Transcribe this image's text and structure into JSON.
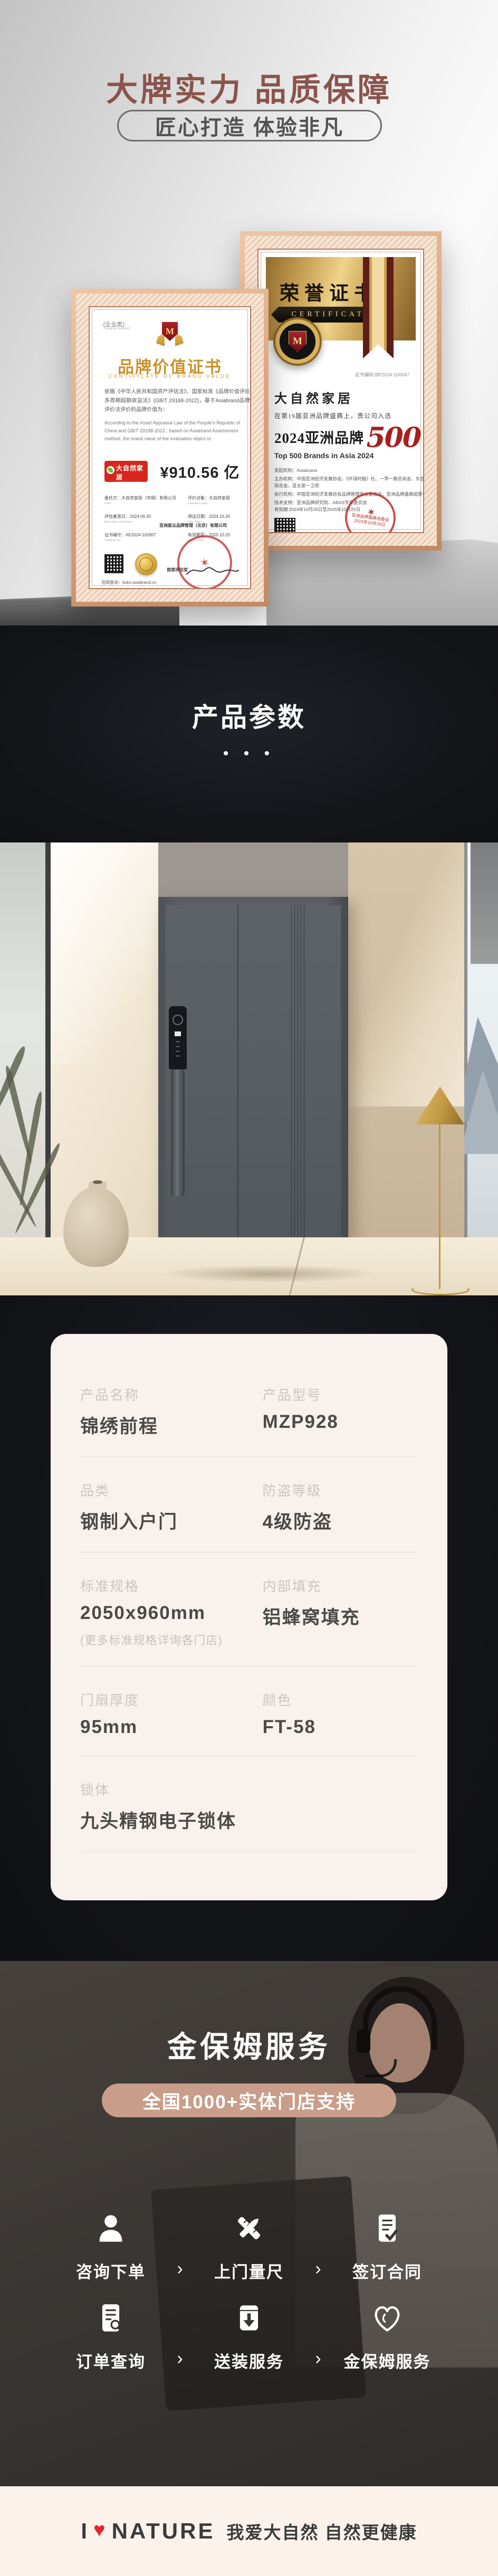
{
  "colors": {
    "hero_title": "#8a544c",
    "pill_tan": "#c89e8a",
    "heart_red": "#e2262c",
    "brand_logo_red": "#d6271f",
    "cert_gold": "#c8922d",
    "dark_section_bg": "#141519",
    "card_bg": "#f9f1ee"
  },
  "hero": {
    "title": "大牌实力 品质保障",
    "subtitle": "匠心打造 体验非凡"
  },
  "cert_left": {
    "category": "·(企业类)·",
    "category_en": "Category Selected",
    "emblem_letter": "M",
    "title": "品牌价值证书",
    "subtitle": "CERTIFICATE OF BRAND VALUE",
    "body_cn": "依据《中华人民共和国资产评估法》、国家标准《品牌价值评价多周期超额收益法》(GB/T 29188-2022)，基于Asiabrand品牌评价法评价的品牌价值为：",
    "body_en": "According to the Asset Appraisal Law of the People's Republic of China and GB/T 29188-2022 , based on Asiabrand Assessment method, the brand value of the evaluation object is:",
    "brand_cn": "大自然家居",
    "brand_en": "NATURE HOME",
    "value": "¥910.56 亿",
    "fields": [
      {
        "label": "委托方：大自然家居（中国）有限公司",
        "sub": "Client"
      },
      {
        "label": "评价对象：大自然家居",
        "sub": "Evaluation target"
      },
      {
        "label": "评估基准日：2024.09.30",
        "sub": "Base Date of Evaluation"
      },
      {
        "label": "颁证日期：2024.10.26",
        "sub": "Issue Date"
      },
      {
        "label": "证书编号：AE2024-102657",
        "sub": "Certificate No."
      },
      {
        "label": "有效期至：2025.10.25",
        "sub": "Effective Date"
      }
    ],
    "stamp_company": "亚洲星云品牌管理（北京）有限公司",
    "stamp_role": "首席评估官",
    "stamp_star": "✶",
    "website": "官网查询：bsks.asiabrand.cn"
  },
  "cert_right": {
    "title": "荣誉证书",
    "ribbon": "CERTIFICATE",
    "medal_letter": "M",
    "code": "证书编码:BP2024-100047",
    "brand": "大自然家居",
    "line1": "在第19届亚洲品牌盛典上，贵公司入选",
    "award_prefix": "2024亚洲品牌",
    "award_number": "500",
    "award_suffix": "强",
    "award_en": "Top 500 Brands in Asia 2024",
    "orgs": [
      "发起机构：Asiabrand",
      "主办机构：中国亚洲经济发展协会、《环球时报》社、一带一路总商会、东盟-中国工商总会、亚太第一卫视",
      "执行机构：中国亚洲经济发展协会品牌管理专业委员会、亚洲品牌盛典组委会",
      "技术支持：亚洲品牌研究院、ABAS专家委员会"
    ],
    "validity": "有效期:2024年10月26日至2025年10月25日",
    "stamp_text": "亚洲品牌盛典组委会",
    "stamp_date": "2024年10月26日",
    "stamp_star": "✶"
  },
  "params_section": {
    "title": "产品参数",
    "dots": "• • •",
    "rows": [
      {
        "l_label": "产品名称",
        "l_value": "锦绣前程",
        "r_label": "产品型号",
        "r_value": "MZP928"
      },
      {
        "l_label": "品类",
        "l_value": "钢制入户门",
        "r_label": "防盗等级",
        "r_value": "4级防盗"
      },
      {
        "l_label": "标准规格",
        "l_value": "2050x960mm",
        "l_note": "(更多标准规格详询各门店)",
        "r_label": "内部填充",
        "r_value": "铝蜂窝填充"
      },
      {
        "l_label": "门扇厚度",
        "l_value": "95mm",
        "r_label": "颜色",
        "r_value": "FT-58"
      },
      {
        "l_label": "锁体",
        "l_value": "九头精钢电子锁体"
      }
    ]
  },
  "service": {
    "title": "金保姆服务",
    "pill": "全国1000+实体门店支持",
    "chevron": "›",
    "steps_row1": [
      {
        "label": "咨询下单",
        "icon": "user-icon"
      },
      {
        "label": "上门量尺",
        "icon": "measure-icon"
      },
      {
        "label": "签订合同",
        "icon": "contract-icon"
      }
    ],
    "steps_row2": [
      {
        "label": "订单查询",
        "icon": "order-search-icon"
      },
      {
        "label": "送装服务",
        "icon": "delivery-icon"
      },
      {
        "label": "金保姆服务",
        "icon": "care-heart-icon"
      }
    ],
    "lock_dots": "• • •",
    "lock_pad": "• • •\n• • •\n• • •\n• • •"
  },
  "footer": {
    "logo_i": "I",
    "logo_heart": "♥",
    "logo_word": "NATURE",
    "slogan": "我爱大自然 自然更健康"
  }
}
